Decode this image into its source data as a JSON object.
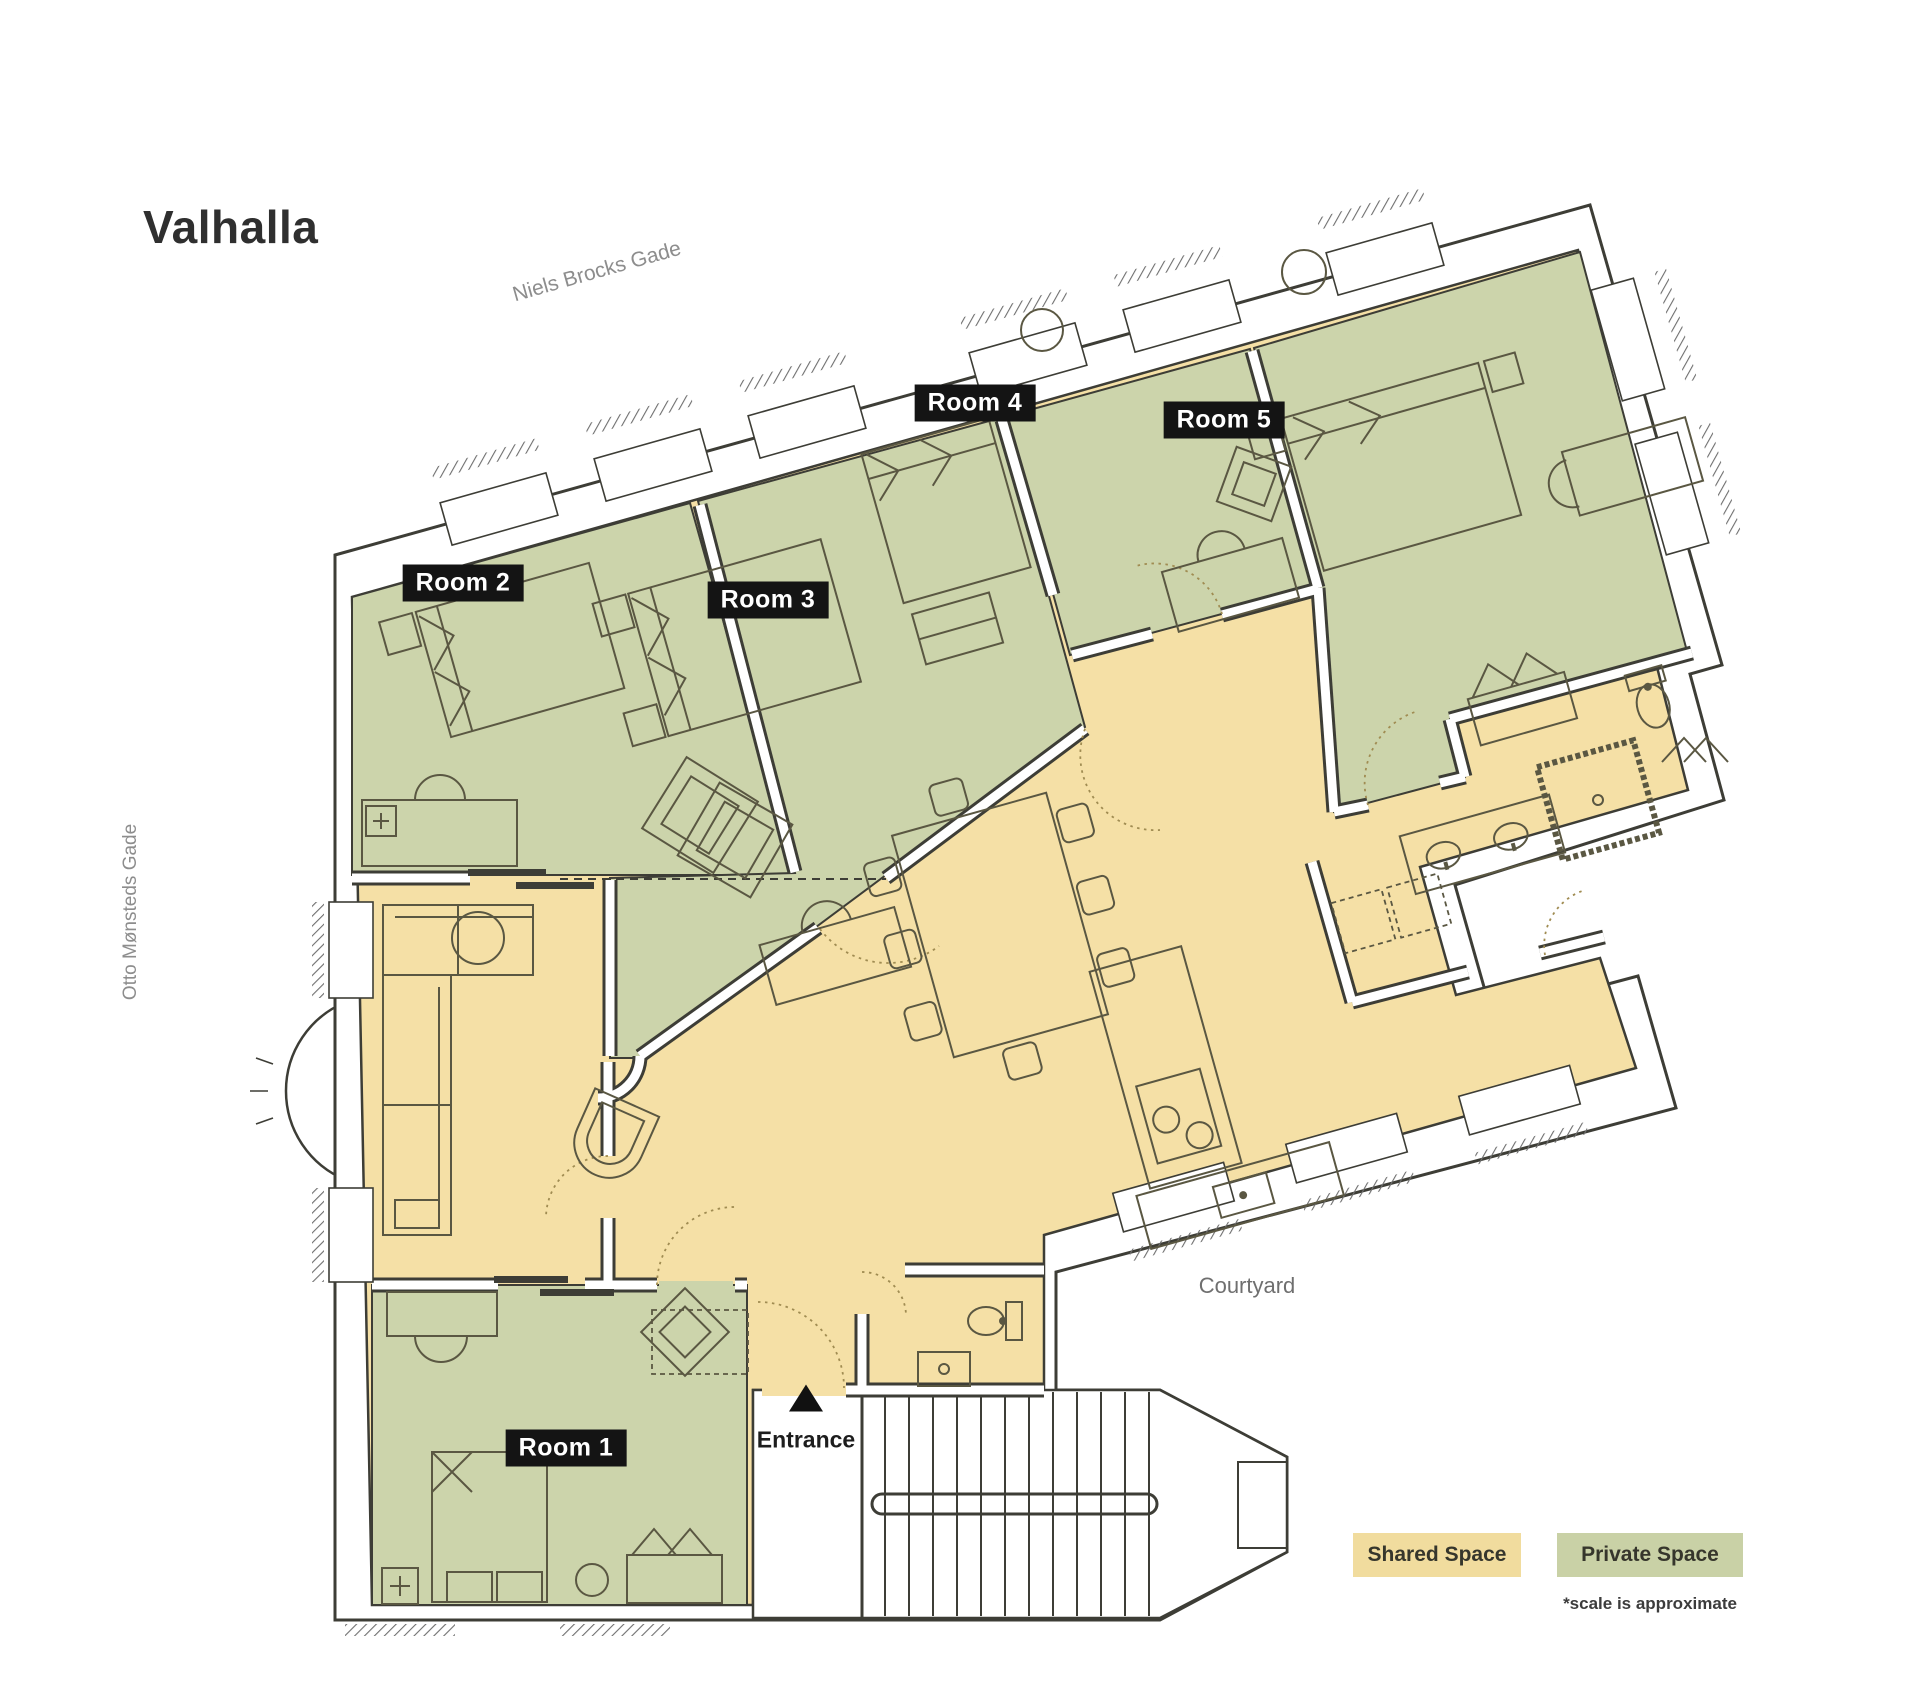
{
  "title": "Valhalla",
  "streets": {
    "top": "Niels Brocks Gade",
    "left": "Otto Mønsteds Gade"
  },
  "labels": {
    "courtyard": "Courtyard",
    "entrance": "Entrance"
  },
  "rooms": [
    {
      "label": "Room 1"
    },
    {
      "label": "Room 2"
    },
    {
      "label": "Room 3"
    },
    {
      "label": "Room 4"
    },
    {
      "label": "Room 5"
    }
  ],
  "legend": {
    "shared_label": "Shared Space",
    "private_label": "Private Space",
    "note": "*scale is approximate"
  },
  "icons": {
    "entrance_marker": "triangle-up"
  },
  "palette": {
    "shared_floor": "#f5e0a6",
    "private_floor": "#ccd4ab",
    "chip_shared": "#f1dc9e",
    "chip_private": "#c9d1a6",
    "wall_ink": "#3d3d36"
  }
}
